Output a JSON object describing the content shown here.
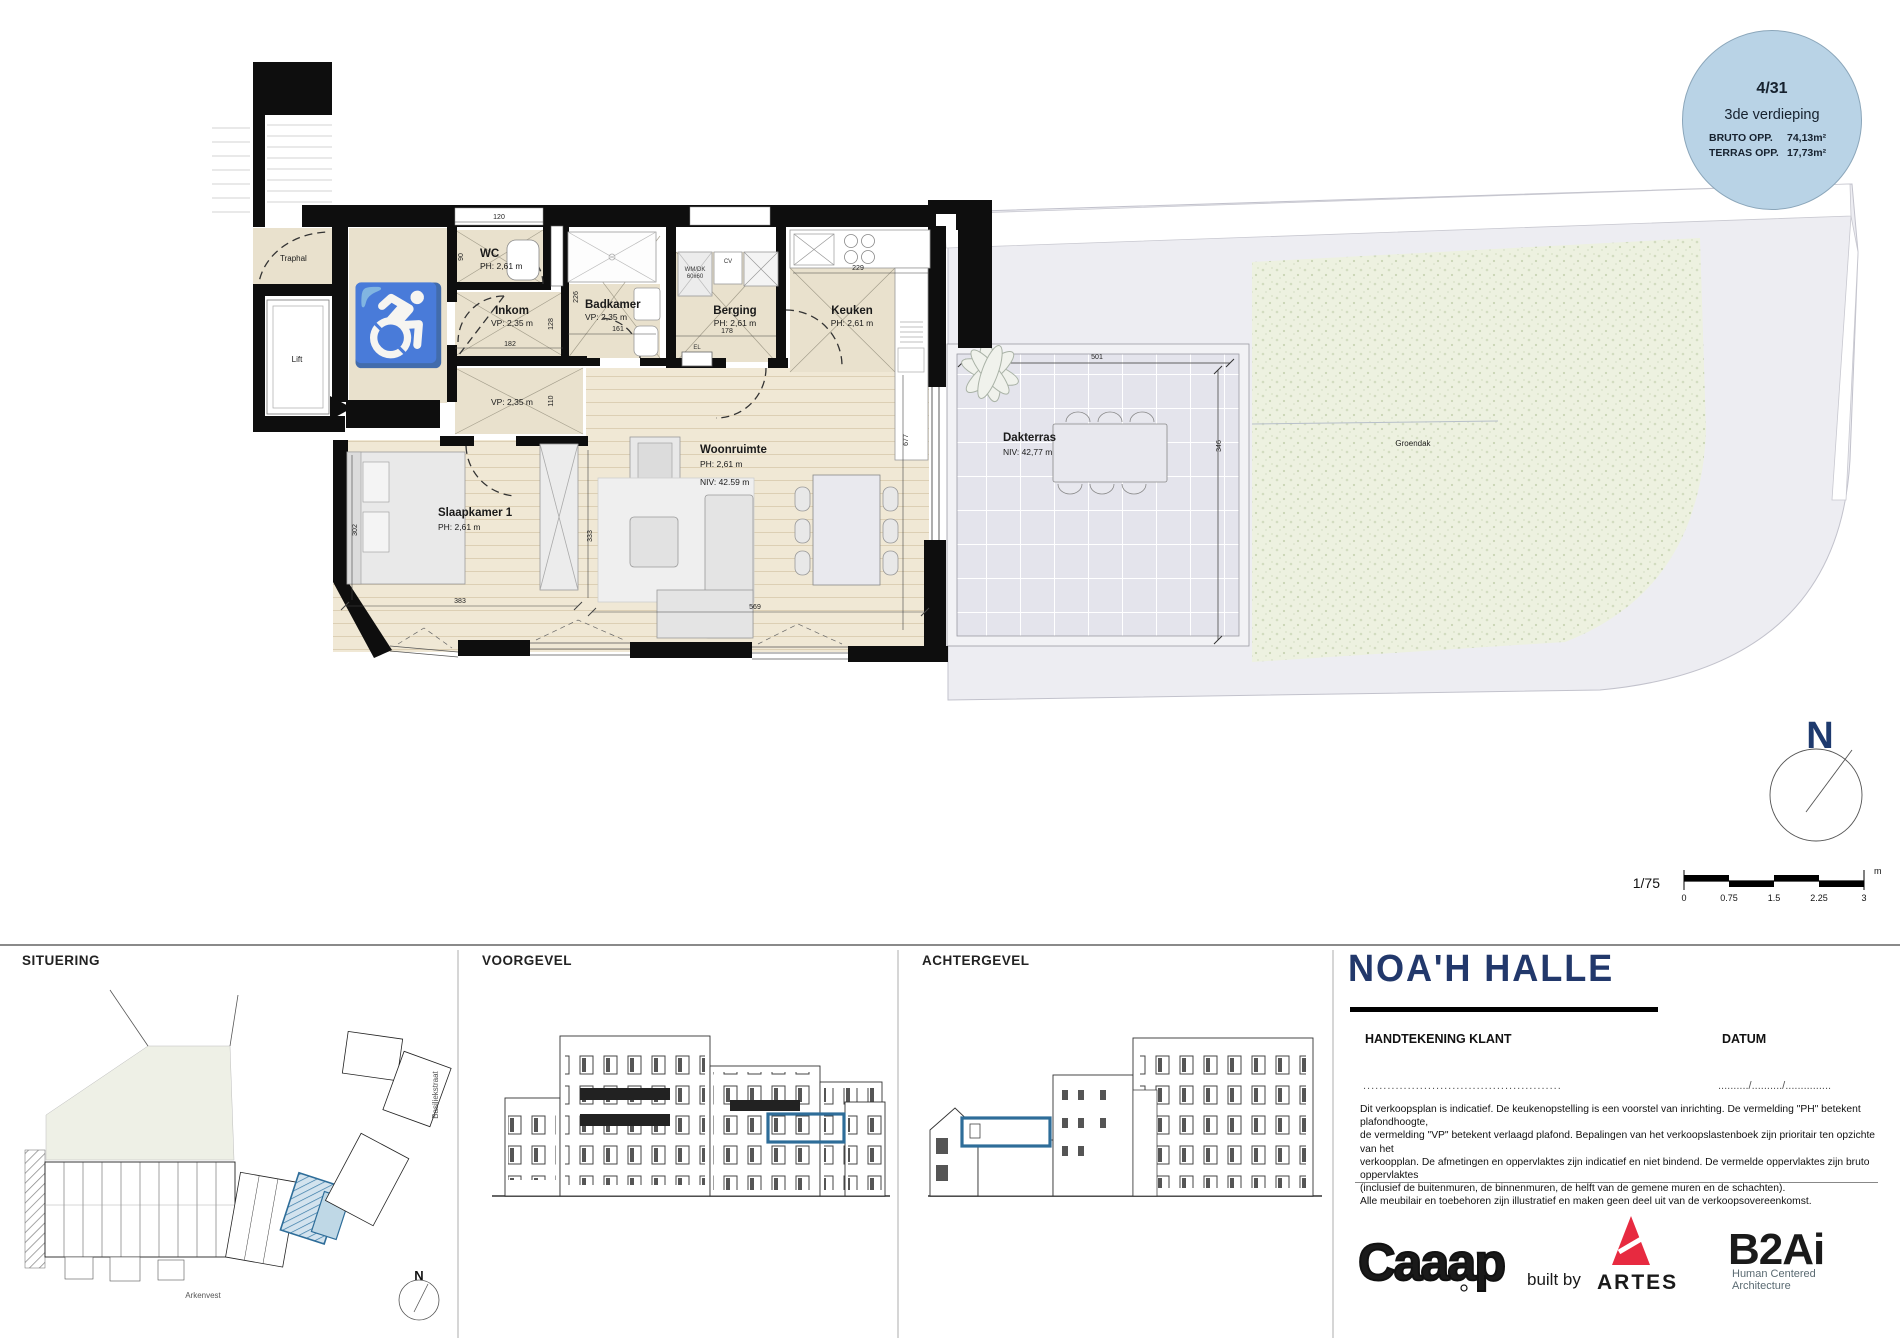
{
  "badge": {
    "unit_number": "4/31",
    "floor": "3de verdieping",
    "rows": [
      {
        "label": "BRUTO OPP.",
        "value": "74,13m²"
      },
      {
        "label": "TERRAS OPP.",
        "value": "17,73m²"
      }
    ]
  },
  "plan": {
    "rooms": {
      "traphal": "Traphal",
      "lift": "Lift",
      "wc_name": "WC",
      "wc_ph": "PH: 2,61 m",
      "inkom_name": "Inkom",
      "inkom_vp": "VP: 2,35 m",
      "hal_vp": "VP: 2,35 m",
      "badkamer_name": "Badkamer",
      "badkamer_vp": "VP: 2,35 m",
      "berging_name": "Berging",
      "berging_ph": "PH: 2,61 m",
      "keuken_name": "Keuken",
      "keuken_ph": "PH: 2,61 m",
      "woonruimte_name": "Woonruimte",
      "woonruimte_ph": "PH: 2,61 m",
      "woonruimte_niv": "NIV: 42.59 m",
      "slaapkamer_name": "Slaapkamer 1",
      "slaapkamer_ph": "PH: 2,61 m",
      "dakterras_name": "Dakterras",
      "dakterras_niv": "NIV: 42,77 m",
      "groendak": "Groendak"
    },
    "fixtures": {
      "wm1": "WM/DK",
      "wm2": "60x60",
      "cv": "CV",
      "el": "EL"
    },
    "dimensions": [
      "120",
      "90",
      "128",
      "182",
      "110",
      "226",
      "161",
      "178",
      "229",
      "677",
      "302",
      "383",
      "333",
      "569",
      "501",
      "346"
    ],
    "icons": {
      "wheelchair": "♿"
    },
    "north_letter": "N",
    "scale": {
      "ratio": "1/75",
      "ticks": [
        "0",
        "0.75",
        "1.5",
        "2.25",
        "3"
      ],
      "unit": "m"
    }
  },
  "panels": {
    "situering": "SITUERING",
    "voorgevel": "VOORGEVEL",
    "achtergevel": "ACHTERGEVEL"
  },
  "situering": {
    "street_bottom": "Arkenvest",
    "street_right": "Basiliekstraat",
    "north_letter": "N"
  },
  "titleblock": {
    "project_title": "NOA'H HALLE",
    "signature_label": "HANDTEKENING KLANT",
    "date_label": "DATUM",
    "signature_dots": ".................................................",
    "date_dots": "........../........../...............",
    "disclaimer": "Dit verkoopsplan is indicatief. De keukenopstelling is een voorstel van inrichting. De vermelding \"PH\" betekent plafondhoogte,\nde vermelding \"VP\" betekent verlaagd plafond. Bepalingen van het verkoopslastenboek zijn prioritair ten opzichte van het\nverkoopplan. De afmetingen en oppervlaktes zijn indicatief en niet bindend. De vermelde oppervlaktes zijn bruto oppervlaktes\n(inclusief de buitenmuren, de binnenmuren, de helft van de gemene muren en de schachten).\nAlle meubilair en toebehoren zijn illustratief en maken geen deel uit van de verkoopsovereenkomst."
  },
  "logos": {
    "caaap": "Caaap",
    "built_by": "built by",
    "artes": "ARTES",
    "b2ai": "B2Ai",
    "b2ai_tagline": "Human Centered\nArchitecture"
  },
  "colors": {
    "accent_blue": "#2e6d99",
    "badge_blue": "#b9d3e6",
    "navy": "#22386b",
    "artes_red": "#e72a40",
    "b2ai_teal": "#275a70"
  }
}
